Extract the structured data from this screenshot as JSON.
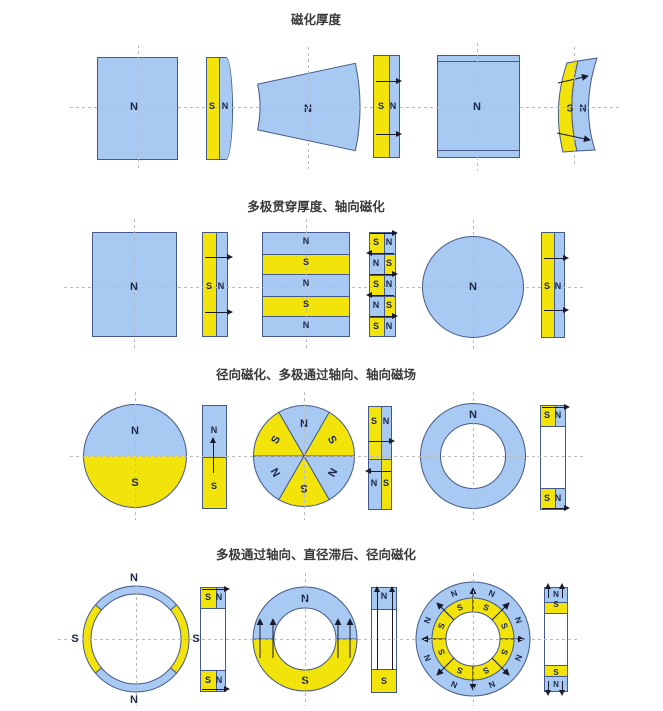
{
  "labels": {
    "n": "N",
    "s": "S"
  },
  "sections": [
    {
      "title": "磁化厚度"
    },
    {
      "title": "多极贯穿厚度、轴向磁化"
    },
    {
      "title": "径向磁化、多极通过轴向、轴向磁场"
    },
    {
      "title": "多极通过轴向、直径滞后、径向磁化"
    }
  ],
  "colors": {
    "blue": "#A7C9F2",
    "yellow": "#F2E30B",
    "outline": "#44598C",
    "label_ink": "#1C2749",
    "arrow": "#1A1A2E",
    "dash": "#BBBBBB"
  }
}
